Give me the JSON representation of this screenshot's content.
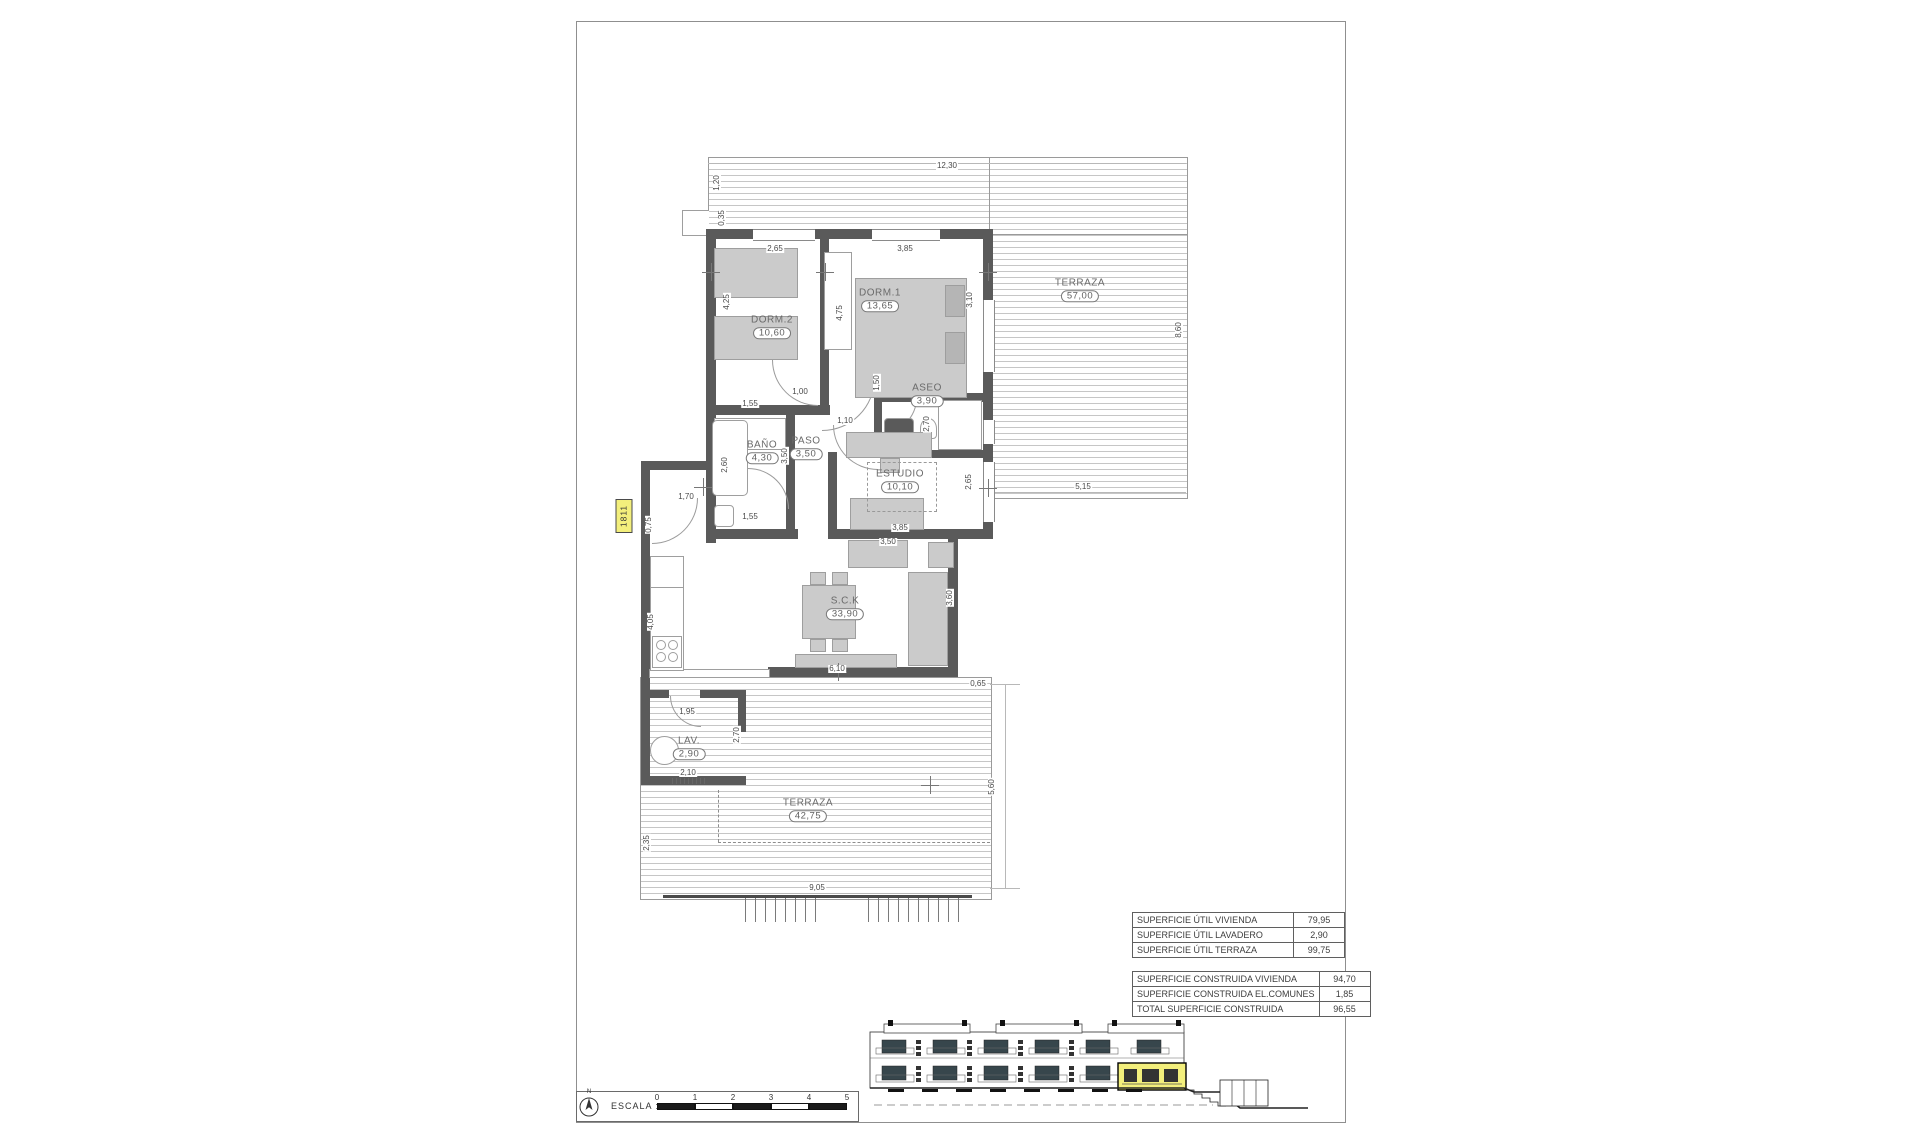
{
  "sheet": {
    "unit_tag": "1811",
    "scale_box": {
      "label": "ESCALA :",
      "north_label": "N",
      "ticks": [
        "0",
        "1",
        "2",
        "3",
        "4",
        "5"
      ]
    },
    "area_tables": {
      "util": [
        {
          "label": "SUPERFICIE ÚTIL VIVIENDA",
          "value": "79,95"
        },
        {
          "label": "SUPERFICIE ÚTIL LAVADERO",
          "value": "2,90"
        },
        {
          "label": "SUPERFICIE ÚTIL TERRAZA",
          "value": "99,75"
        }
      ],
      "construida": [
        {
          "label": "SUPERFICIE CONSTRUIDA VIVIENDA",
          "value": "94,70"
        },
        {
          "label": "SUPERFICIE CONSTRUIDA EL.COMUNES",
          "value": "1,85"
        },
        {
          "label": "TOTAL SUPERFICIE CONSTRUIDA",
          "value": "96,55"
        }
      ]
    }
  },
  "plan": {
    "rooms": [
      {
        "name": "DORM.2",
        "area": "10,60",
        "x": 772,
        "y": 327
      },
      {
        "name": "DORM.1",
        "area": "13,65",
        "x": 880,
        "y": 300
      },
      {
        "name": "ASEO",
        "area": "3,90",
        "x": 927,
        "y": 395
      },
      {
        "name": "BAÑO",
        "area": "4,30",
        "x": 762,
        "y": 452
      },
      {
        "name": "PASO",
        "area": "3,50",
        "x": 806,
        "y": 448
      },
      {
        "name": "ESTUDIO",
        "area": "10,10",
        "x": 900,
        "y": 481
      },
      {
        "name": "S.C.K",
        "area": "33,90",
        "x": 845,
        "y": 608
      },
      {
        "name": "LAV.",
        "area": "2,90",
        "x": 689,
        "y": 748
      },
      {
        "name": "TERRAZA",
        "area": "57,00",
        "x": 1080,
        "y": 290
      },
      {
        "name": "TERRAZA",
        "area": "42,75",
        "x": 808,
        "y": 810
      }
    ],
    "dims_h": [
      {
        "t": "12,30",
        "x": 947,
        "y": 166
      },
      {
        "t": "2,65",
        "x": 775,
        "y": 249
      },
      {
        "t": "3,85",
        "x": 905,
        "y": 249
      },
      {
        "t": "1,00",
        "x": 800,
        "y": 392
      },
      {
        "t": "1,55",
        "x": 750,
        "y": 404
      },
      {
        "t": "1,10",
        "x": 845,
        "y": 421
      },
      {
        "t": "1,55",
        "x": 750,
        "y": 517
      },
      {
        "t": "1,70",
        "x": 686,
        "y": 497
      },
      {
        "t": "5,15",
        "x": 1083,
        "y": 487
      },
      {
        "t": "3,85",
        "x": 900,
        "y": 528
      },
      {
        "t": "3,50",
        "x": 888,
        "y": 542
      },
      {
        "t": "6,10",
        "x": 837,
        "y": 669
      },
      {
        "t": "1,95",
        "x": 687,
        "y": 712
      },
      {
        "t": "2,10",
        "x": 688,
        "y": 773
      },
      {
        "t": "0,65",
        "x": 978,
        "y": 684
      },
      {
        "t": "9,05",
        "x": 817,
        "y": 888
      }
    ],
    "dims_v": [
      {
        "t": "1,20",
        "x": 717,
        "y": 183
      },
      {
        "t": "0,35",
        "x": 722,
        "y": 218
      },
      {
        "t": "4,25",
        "x": 727,
        "y": 302
      },
      {
        "t": "4,75",
        "x": 840,
        "y": 313
      },
      {
        "t": "3,10",
        "x": 970,
        "y": 300
      },
      {
        "t": "8,60",
        "x": 1179,
        "y": 330
      },
      {
        "t": "1,50",
        "x": 877,
        "y": 383
      },
      {
        "t": "2,70",
        "x": 927,
        "y": 424
      },
      {
        "t": "2,60",
        "x": 725,
        "y": 465
      },
      {
        "t": "3,50",
        "x": 785,
        "y": 456
      },
      {
        "t": "2,65",
        "x": 969,
        "y": 482
      },
      {
        "t": "0,75",
        "x": 649,
        "y": 525
      },
      {
        "t": "4,05",
        "x": 651,
        "y": 622
      },
      {
        "t": "3,60",
        "x": 950,
        "y": 598
      },
      {
        "t": "2,70",
        "x": 737,
        "y": 735
      },
      {
        "t": "5,60",
        "x": 992,
        "y": 787
      },
      {
        "t": "2,35",
        "x": 647,
        "y": 843
      }
    ]
  },
  "colors": {
    "wall": "#5a5a5a",
    "highlight_yellow": "#f3ef7c",
    "elevation_glass": "#37464c"
  }
}
